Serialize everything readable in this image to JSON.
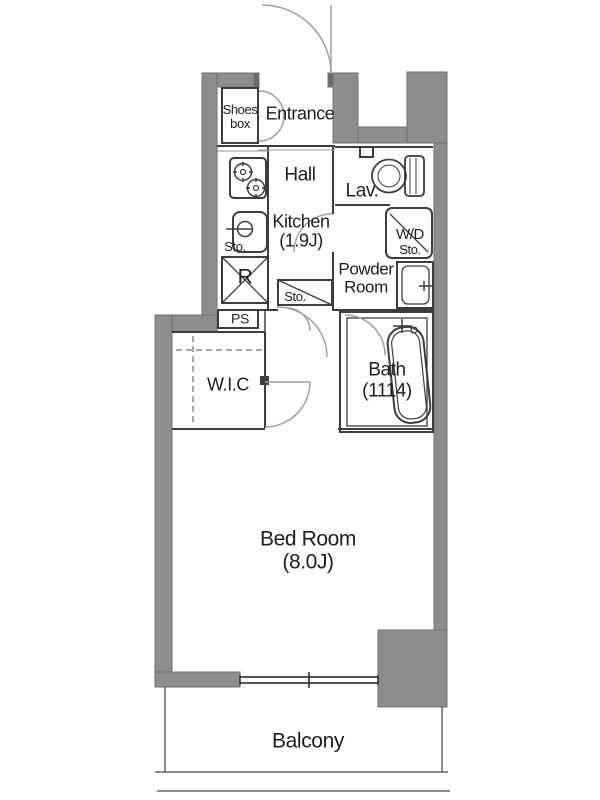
{
  "rooms": {
    "entrance": {
      "name": "Entrance"
    },
    "shoes_box": {
      "line1": "Shoes",
      "line2": "box"
    },
    "hall": {
      "name": "Hall"
    },
    "kitchen": {
      "name": "Kitchen",
      "size": "(1.9J)"
    },
    "lavatory": {
      "name": "Lav."
    },
    "wd_storage": {
      "line1": "W/D",
      "line2": "Sto."
    },
    "powder_room": {
      "line1": "Powder",
      "line2": "Room"
    },
    "bath": {
      "name": "Bath",
      "size": "(1114)"
    },
    "wic": {
      "name": "W.I.C"
    },
    "bedroom": {
      "name": "Bed Room",
      "size": "(8.0J)"
    },
    "balcony": {
      "name": "Balcony"
    }
  },
  "fixtures": {
    "kitchen_storage": "Sto.",
    "hall_storage": "Sto.",
    "refrigerator": "R",
    "pipe_space": "PS"
  },
  "colors": {
    "wall": "#8d8d8d",
    "wall_edge": "#707070",
    "line": "#3d3d3d",
    "door_arc": "#9f9f9f",
    "text": "#1e1e1e",
    "background": "#ffffff"
  }
}
